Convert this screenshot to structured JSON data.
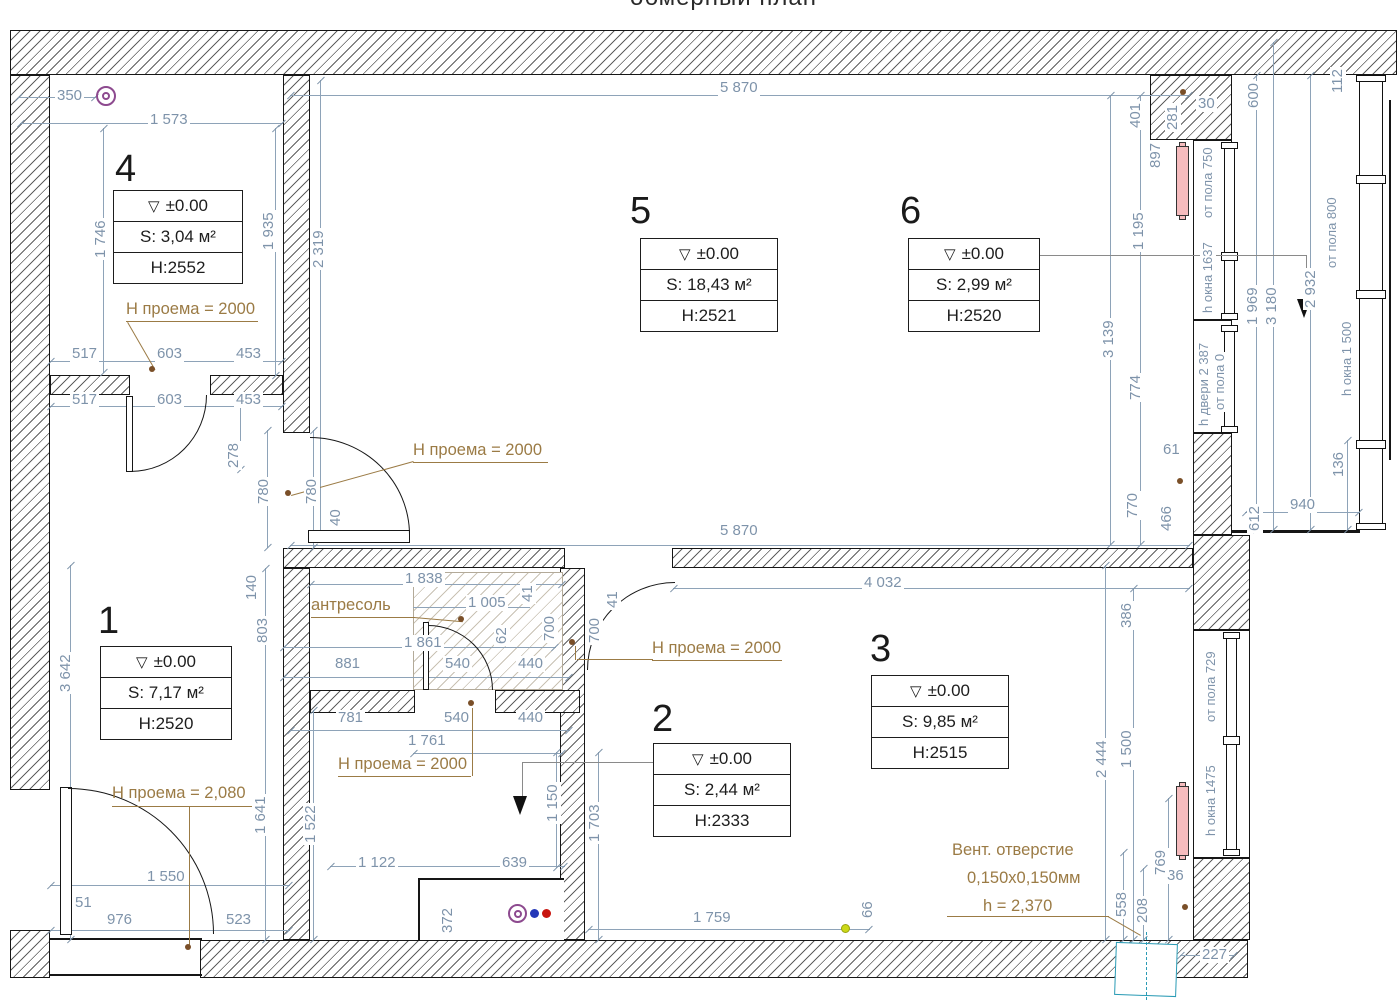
{
  "title": "обмерный план",
  "rooms": [
    {
      "number": "1",
      "elev": "±0.00",
      "area": "S: 7,17 м²",
      "height": "H:2520"
    },
    {
      "number": "2",
      "elev": "±0.00",
      "area": "S: 2,44 м²",
      "height": "H:2333"
    },
    {
      "number": "3",
      "elev": "±0.00",
      "area": "S: 9,85 м²",
      "height": "H:2515"
    },
    {
      "number": "4",
      "elev": "±0.00",
      "area": "S: 3,04 м²",
      "height": "H:2552"
    },
    {
      "number": "5",
      "elev": "±0.00",
      "area": "S: 18,43 м²",
      "height": "H:2521"
    },
    {
      "number": "6",
      "elev": "±0.00",
      "area": "S: 2,99 м²",
      "height": "H:2520"
    }
  ],
  "labels": {
    "np2000": "Н проема = 2000",
    "np2080": "Н проема = 2,080",
    "antresol": "антресоль",
    "vent1": "Вент. отверстие",
    "vent2": "0,150х0,150мм",
    "vent3": "h = 2,370"
  },
  "wins": {
    "w1a": "от пола 750",
    "w1b": "h окна 1637",
    "d1a": "h двери 2 387",
    "d1b": "от пола 0",
    "b1a": "от пола 800",
    "b1b": "h окна 1 500",
    "w2a": "от пола 729",
    "w2b": "h окна 1475"
  },
  "level_mark": "▽",
  "colors": {
    "dim": "#7e93aa",
    "brown": "#9b7b45",
    "radiator": "#f6bcbe",
    "vent_blue": "#2a9bb5",
    "purple": "#8d4a8f"
  },
  "dims": [
    {
      "t": "350",
      "x": 55,
      "y": 88
    },
    {
      "t": "1 573",
      "x": 148,
      "y": 112
    },
    {
      "t": "517",
      "x": 70,
      "y": 346
    },
    {
      "t": "603",
      "x": 155,
      "y": 346
    },
    {
      "t": "453",
      "x": 234,
      "y": 346
    },
    {
      "t": "517",
      "x": 70,
      "y": 392
    },
    {
      "t": "603",
      "x": 155,
      "y": 392
    },
    {
      "t": "453",
      "x": 234,
      "y": 392
    },
    {
      "t": "5 870",
      "x": 718,
      "y": 80
    },
    {
      "t": "5 870",
      "x": 718,
      "y": 523
    },
    {
      "t": "30",
      "x": 1196,
      "y": 96
    },
    {
      "t": "4 032",
      "x": 862,
      "y": 575
    },
    {
      "t": "61",
      "x": 1161,
      "y": 442
    },
    {
      "t": "940",
      "x": 1288,
      "y": 497
    },
    {
      "t": "1 838",
      "x": 403,
      "y": 571
    },
    {
      "t": "1 005",
      "x": 466,
      "y": 595
    },
    {
      "t": "1 861",
      "x": 402,
      "y": 635
    },
    {
      "t": "881",
      "x": 333,
      "y": 656
    },
    {
      "t": "540",
      "x": 443,
      "y": 656
    },
    {
      "t": "440",
      "x": 516,
      "y": 656
    },
    {
      "t": "781",
      "x": 336,
      "y": 710
    },
    {
      "t": "540",
      "x": 442,
      "y": 710
    },
    {
      "t": "440",
      "x": 516,
      "y": 710
    },
    {
      "t": "1 761",
      "x": 406,
      "y": 733
    },
    {
      "t": "1 550",
      "x": 145,
      "y": 869
    },
    {
      "t": "51",
      "x": 73,
      "y": 895
    },
    {
      "t": "976",
      "x": 105,
      "y": 912
    },
    {
      "t": "523",
      "x": 224,
      "y": 912
    },
    {
      "t": "1 122",
      "x": 356,
      "y": 855
    },
    {
      "t": "639",
      "x": 500,
      "y": 855
    },
    {
      "t": "1 759",
      "x": 691,
      "y": 910
    },
    {
      "t": "36",
      "x": 1165,
      "y": 868
    },
    {
      "t": "227",
      "x": 1200,
      "y": 947
    },
    {
      "t": "1 746",
      "x": 93,
      "y": 260,
      "r": 1
    },
    {
      "t": "1 935",
      "x": 261,
      "y": 252,
      "r": 1
    },
    {
      "t": "2 319",
      "x": 311,
      "y": 270,
      "r": 1
    },
    {
      "t": "278",
      "x": 226,
      "y": 470,
      "r": 1
    },
    {
      "t": "780",
      "x": 256,
      "y": 506,
      "r": 1
    },
    {
      "t": "780",
      "x": 304,
      "y": 506,
      "r": 1
    },
    {
      "t": "40",
      "x": 328,
      "y": 528,
      "r": 1
    },
    {
      "t": "140",
      "x": 244,
      "y": 602,
      "r": 1
    },
    {
      "t": "401",
      "x": 1128,
      "y": 130,
      "r": 1
    },
    {
      "t": "281",
      "x": 1165,
      "y": 132,
      "r": 1
    },
    {
      "t": "897",
      "x": 1148,
      "y": 170,
      "r": 1
    },
    {
      "t": "600",
      "x": 1246,
      "y": 110,
      "r": 1
    },
    {
      "t": "112",
      "x": 1330,
      "y": 95,
      "r": 1
    },
    {
      "t": "1 195",
      "x": 1131,
      "y": 252,
      "r": 1
    },
    {
      "t": "3 139",
      "x": 1101,
      "y": 360,
      "r": 1
    },
    {
      "t": "774",
      "x": 1128,
      "y": 402,
      "r": 1
    },
    {
      "t": "1 969",
      "x": 1245,
      "y": 327,
      "r": 1
    },
    {
      "t": "3 180",
      "x": 1264,
      "y": 327,
      "r": 1
    },
    {
      "t": "2 932",
      "x": 1303,
      "y": 310,
      "r": 1
    },
    {
      "t": "770",
      "x": 1125,
      "y": 520,
      "r": 1
    },
    {
      "t": "466",
      "x": 1159,
      "y": 533,
      "r": 1
    },
    {
      "t": "612",
      "x": 1247,
      "y": 533,
      "r": 1
    },
    {
      "t": "136",
      "x": 1331,
      "y": 479,
      "r": 1
    },
    {
      "t": "41",
      "x": 520,
      "y": 604,
      "r": 1
    },
    {
      "t": "62",
      "x": 494,
      "y": 646,
      "r": 1
    },
    {
      "t": "700",
      "x": 542,
      "y": 643,
      "r": 1
    },
    {
      "t": "41",
      "x": 605,
      "y": 610,
      "r": 1
    },
    {
      "t": "700",
      "x": 587,
      "y": 645,
      "r": 1
    },
    {
      "t": "386",
      "x": 1119,
      "y": 630,
      "r": 1
    },
    {
      "t": "3 642",
      "x": 58,
      "y": 694,
      "r": 1
    },
    {
      "t": "803",
      "x": 255,
      "y": 645,
      "r": 1
    },
    {
      "t": "2 444",
      "x": 1094,
      "y": 780,
      "r": 1
    },
    {
      "t": "1 500",
      "x": 1119,
      "y": 770,
      "r": 1
    },
    {
      "t": "1 150",
      "x": 545,
      "y": 824,
      "r": 1
    },
    {
      "t": "1 703",
      "x": 587,
      "y": 844,
      "r": 1
    },
    {
      "t": "1 641",
      "x": 253,
      "y": 836,
      "r": 1
    },
    {
      "t": "1 522",
      "x": 303,
      "y": 845,
      "r": 1
    },
    {
      "t": "372",
      "x": 440,
      "y": 935,
      "r": 1
    },
    {
      "t": "66",
      "x": 860,
      "y": 920,
      "r": 1
    },
    {
      "t": "558",
      "x": 1114,
      "y": 919,
      "r": 1
    },
    {
      "t": "208",
      "x": 1135,
      "y": 925,
      "r": 1
    },
    {
      "t": "769",
      "x": 1153,
      "y": 877,
      "r": 1
    }
  ]
}
